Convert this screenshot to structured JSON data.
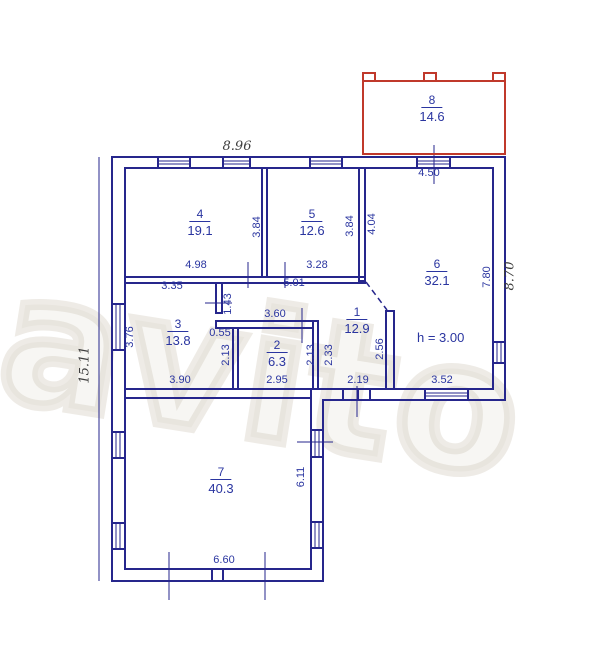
{
  "title": "floor-plan",
  "watermark": "avito",
  "height_note": "h = 3.00",
  "colors": {
    "wall_line": "#26268c",
    "label_text": "#2a35a0",
    "annex_outline": "#c0392b",
    "handwritten_text": "#3d3d3d"
  },
  "rooms": {
    "r1": {
      "num": "1",
      "area": "12.9"
    },
    "r2": {
      "num": "2",
      "area": "6.3"
    },
    "r3": {
      "num": "3",
      "area": "13.8"
    },
    "r4": {
      "num": "4",
      "area": "19.1"
    },
    "r5": {
      "num": "5",
      "area": "12.6"
    },
    "r6": {
      "num": "6",
      "area": "32.1"
    },
    "r7": {
      "num": "7",
      "area": "40.3"
    },
    "r8": {
      "num": "8",
      "area": "14.6"
    }
  },
  "dims": {
    "top_width": "8.96",
    "left_height": "15.11",
    "right_height": "8.70",
    "d450": "4.50",
    "d498": "4.98",
    "d328": "3.28",
    "d384l": "3.84",
    "d384r": "3.84",
    "d404": "4.04",
    "d335": "3.35",
    "d501": "5.01",
    "d143": "1.43",
    "d360": "3.60",
    "d055": "0.55",
    "d376": "3.76",
    "d780": "7.80",
    "d213l": "2.13",
    "d213r": "2.13",
    "d233": "2.33",
    "d256": "2.56",
    "d390": "3.90",
    "d295": "2.95",
    "d219": "2.19",
    "d352": "3.52",
    "d611": "6.11",
    "d660": "6.60"
  }
}
